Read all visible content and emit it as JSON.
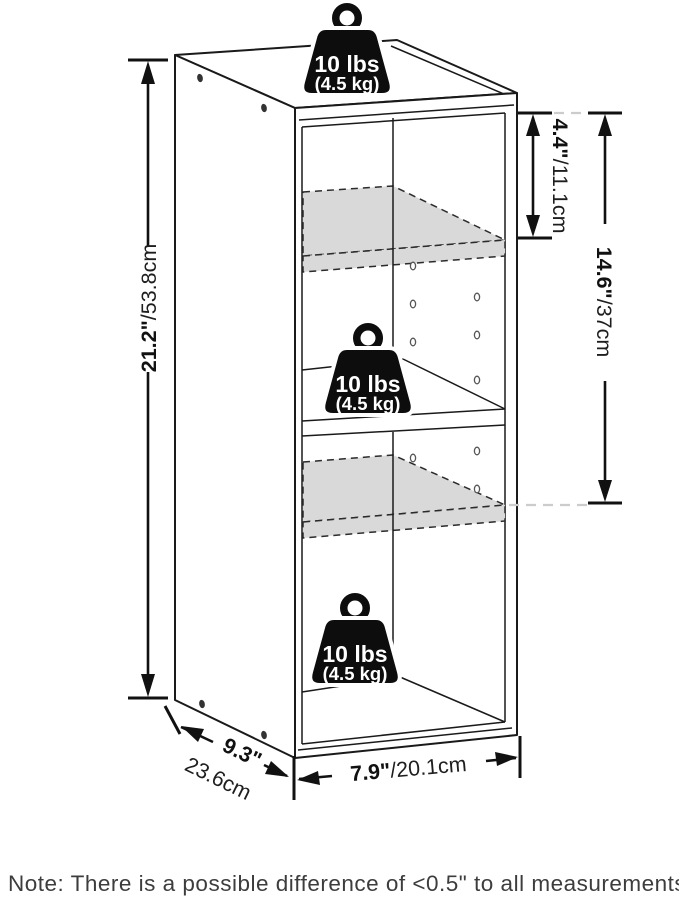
{
  "diagram": {
    "title": "shelf-dimension-diagram",
    "weights": [
      {
        "location": "top",
        "lbs": "10 lbs",
        "kg": "(4.5 kg)"
      },
      {
        "location": "middle",
        "lbs": "10 lbs",
        "kg": "(4.5 kg)"
      },
      {
        "location": "bottom",
        "lbs": "10 lbs",
        "kg": "(4.5 kg)"
      }
    ],
    "dimensions": {
      "height": {
        "imperial": "21.2\"",
        "metric": "/53.8cm"
      },
      "top_shelf_gap": {
        "imperial": "4.4\"",
        "metric": "/11.1cm"
      },
      "shelf_span": {
        "imperial": "14.6\"",
        "metric": "/37cm"
      },
      "depth": {
        "imperial": "9.3\"",
        "metric": "23.6cm"
      },
      "width": {
        "imperial": "7.9\"",
        "metric": "/20.1cm"
      }
    },
    "note": "Note: There is a possible difference of <0.5\" to all measurements."
  }
}
